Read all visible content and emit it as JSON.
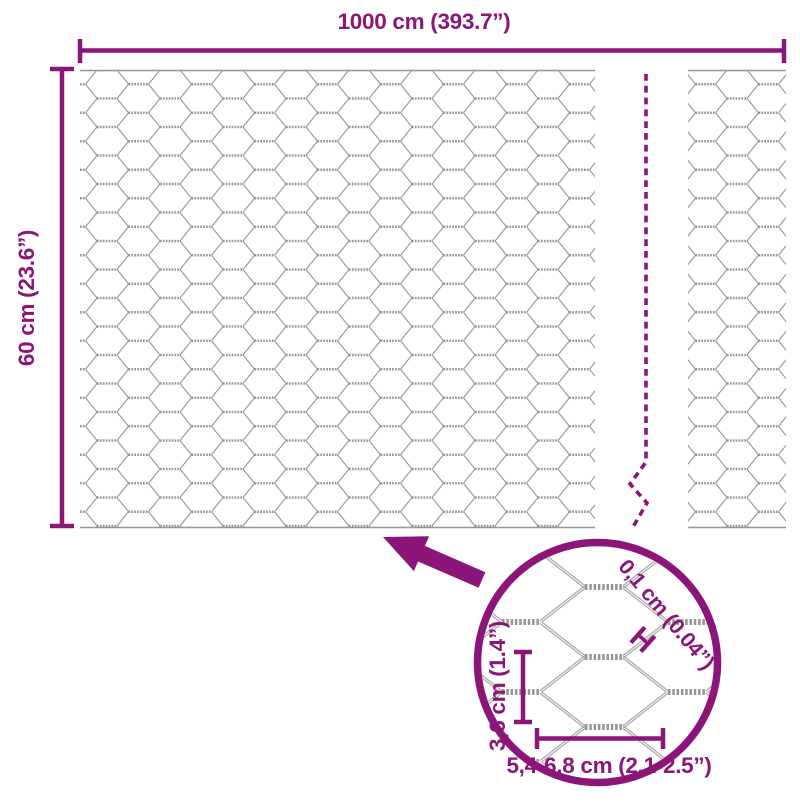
{
  "colors": {
    "accent": "#8B1578",
    "wire": "#969696",
    "wire_light": "#a9a9a9",
    "background": "#ffffff"
  },
  "diagram": {
    "total_width_label": "1000 cm (393.7”)",
    "total_height_label": "60 cm (23.6”)",
    "wire_thickness_label": "0,1 cm (0.04”)",
    "wire_thickness_marker": "H",
    "mesh_height_label": "3,6 cm (1.4”)",
    "mesh_width_label": "5,4-6,8 cm (2.1-2.5”)"
  }
}
